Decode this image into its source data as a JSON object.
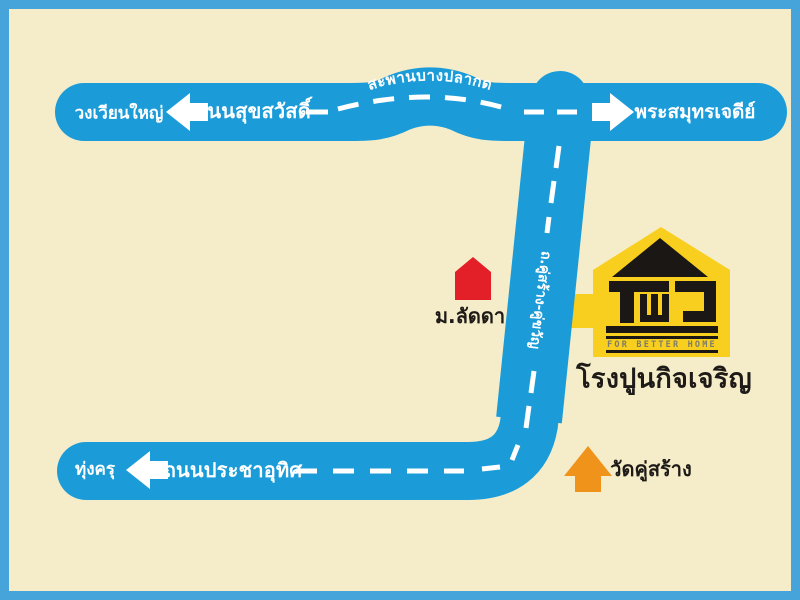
{
  "colors": {
    "background": "#F5EDC9",
    "border": "#47A4DA",
    "road": "#1B9CD9",
    "dash_line": "#FFFFFF",
    "village_red": "#E32028",
    "temple_orange": "#F0931B",
    "logo_yellow": "#F8CF1E",
    "logo_black": "#1A1714",
    "text_ink": "#1E1A17"
  },
  "top_road": {
    "name": "ถนนสุขสวัสดิ์",
    "left_destination": "วงเวียนใหญ่",
    "right_destination": "พระสมุทรเจดีย์",
    "bridge_name": "สะพานบางปลากด"
  },
  "connecting_road": {
    "name": "ถ.คู่สร้าง-คู่ขวัญ"
  },
  "bottom_road": {
    "name": "ถนนประชาอุทิศ",
    "left_destination": "ทุ่งครุ"
  },
  "landmarks": {
    "village": {
      "label": "ม.ลัดดา"
    },
    "temple": {
      "label": "วัดคู่สร้าง"
    },
    "company": {
      "name": "โรงปูนกิจเจริญ",
      "tagline": "FOR BETTER HOME"
    }
  }
}
